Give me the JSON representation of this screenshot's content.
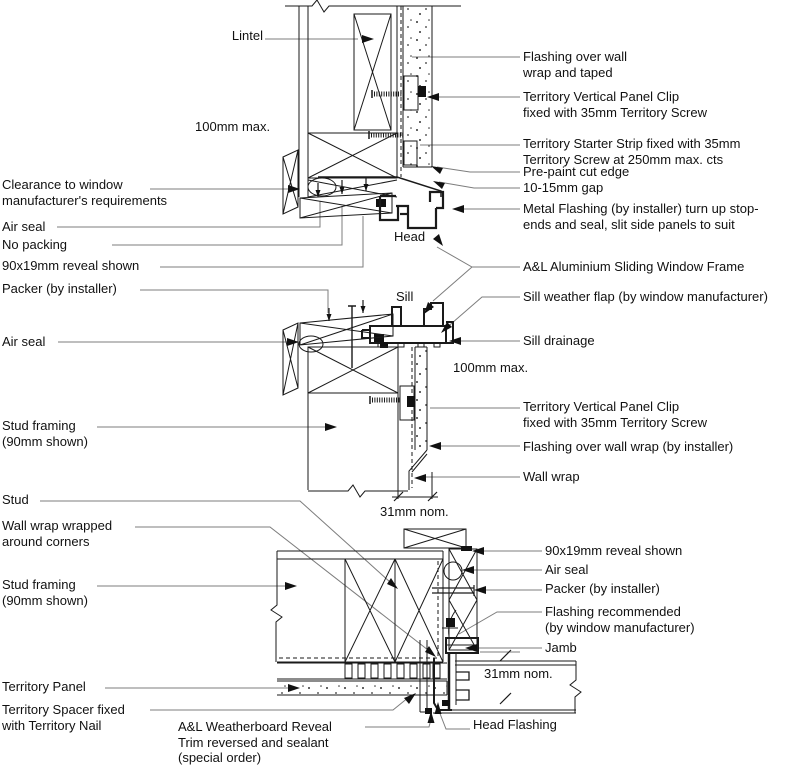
{
  "figure": {
    "kind": "window installation detail drawing",
    "section_tags": [
      "Head",
      "Sill",
      "Jamb"
    ]
  },
  "labels": {
    "head": {
      "lintel": "Lintel",
      "clearance_100mm": "100mm max.",
      "clearance": "Clearance to window\nmanufacturer's requirements",
      "air_seal": "Air seal",
      "no_packing": "No packing",
      "reveal": "90x19mm reveal shown",
      "packer": "Packer (by installer)",
      "flashing_taped": "Flashing over wall\nwrap and taped",
      "panel_clip": "Territory Vertical Panel Clip\nfixed with 35mm Territory Screw",
      "starter_strip": "Territory Starter Strip fixed with 35mm\nTerritory Screw at 250mm max. cts",
      "prepaint_edge": "Pre-paint cut edge",
      "gap": "10-15mm gap",
      "metal_flashing": "Metal Flashing (by installer) turn up stop-\nends and seal, slit side panels to suit",
      "head_tag": "Head",
      "frame": "A&L Aluminium Sliding Window Frame"
    },
    "sill": {
      "air_seal": "Air seal",
      "stud_framing": "Stud framing\n(90mm shown)",
      "sill_tag": "Sill",
      "weather_flap": "Sill weather flap (by window manufacturer)",
      "drainage": "Sill drainage",
      "clearance_100mm": "100mm max.",
      "panel_clip": "Territory Vertical Panel Clip\nfixed with 35mm Territory Screw",
      "flashing": "Flashing over wall wrap (by installer)",
      "wall_wrap": "Wall wrap",
      "dim_31mm": "31mm nom."
    },
    "jamb": {
      "stud": "Stud",
      "wrap_corners": "Wall wrap wrapped\naround corners",
      "stud_framing": "Stud framing\n(90mm shown)",
      "territory_panel": "Territory Panel",
      "spacer": "Territory Spacer fixed\nwith Territory Nail",
      "reveal_trim": "A&L Weatherboard Reveal\nTrim reversed and sealant\n(special order)",
      "reveal": "90x19mm reveal shown",
      "air_seal": "Air seal",
      "packer": "Packer (by installer)",
      "flashing_recommended": "Flashing recommended\n(by window manufacturer)",
      "jamb_tag": "Jamb",
      "dim_31mm": "31mm nom.",
      "head_flashing": "Head Flashing"
    }
  },
  "colors": {
    "line": "#1a1a1a",
    "leader": "#7d7d7d",
    "background": "#ffffff"
  }
}
